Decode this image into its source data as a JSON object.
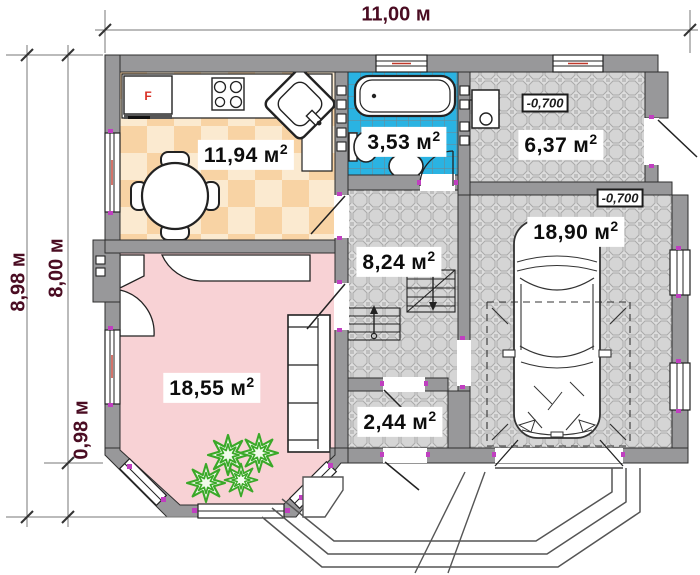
{
  "dimensions": {
    "width_total": "11,00 м",
    "height_total": "8,98 м",
    "height_main": "8,00 м",
    "height_bay": "0,98 м"
  },
  "rooms": [
    {
      "id": "kitchen",
      "area": "11,94",
      "unit": "м",
      "sup": "2"
    },
    {
      "id": "bathroom",
      "area": "3,53",
      "unit": "м",
      "sup": "2"
    },
    {
      "id": "boiler-room",
      "area": "6,37",
      "unit": "м",
      "sup": "2"
    },
    {
      "id": "hallway",
      "area": "8,24",
      "unit": "м",
      "sup": "2"
    },
    {
      "id": "garage",
      "area": "18,90",
      "unit": "м",
      "sup": "2"
    },
    {
      "id": "living-room",
      "area": "18,55",
      "unit": "м",
      "sup": "2"
    },
    {
      "id": "vestibule",
      "area": "2,44",
      "unit": "м",
      "sup": "2"
    }
  ],
  "elevations": [
    {
      "id": "boiler-room-level",
      "value": "-0,700"
    },
    {
      "id": "garage-level",
      "value": "-0,700"
    }
  ],
  "labels": {
    "fridge": "F"
  },
  "colors": {
    "wall": "#98989a",
    "kitchen_floor_light": "#fbead0",
    "kitchen_floor_dark": "#f8d3a4",
    "living_floor": "#f8d2d5",
    "bath_floor": "#2ab3e2",
    "tile_floor": "#dddddd",
    "dimension_text": "#4a0c22",
    "plant_green": "#3aa828",
    "jamb_mark": "#c03fc0"
  }
}
